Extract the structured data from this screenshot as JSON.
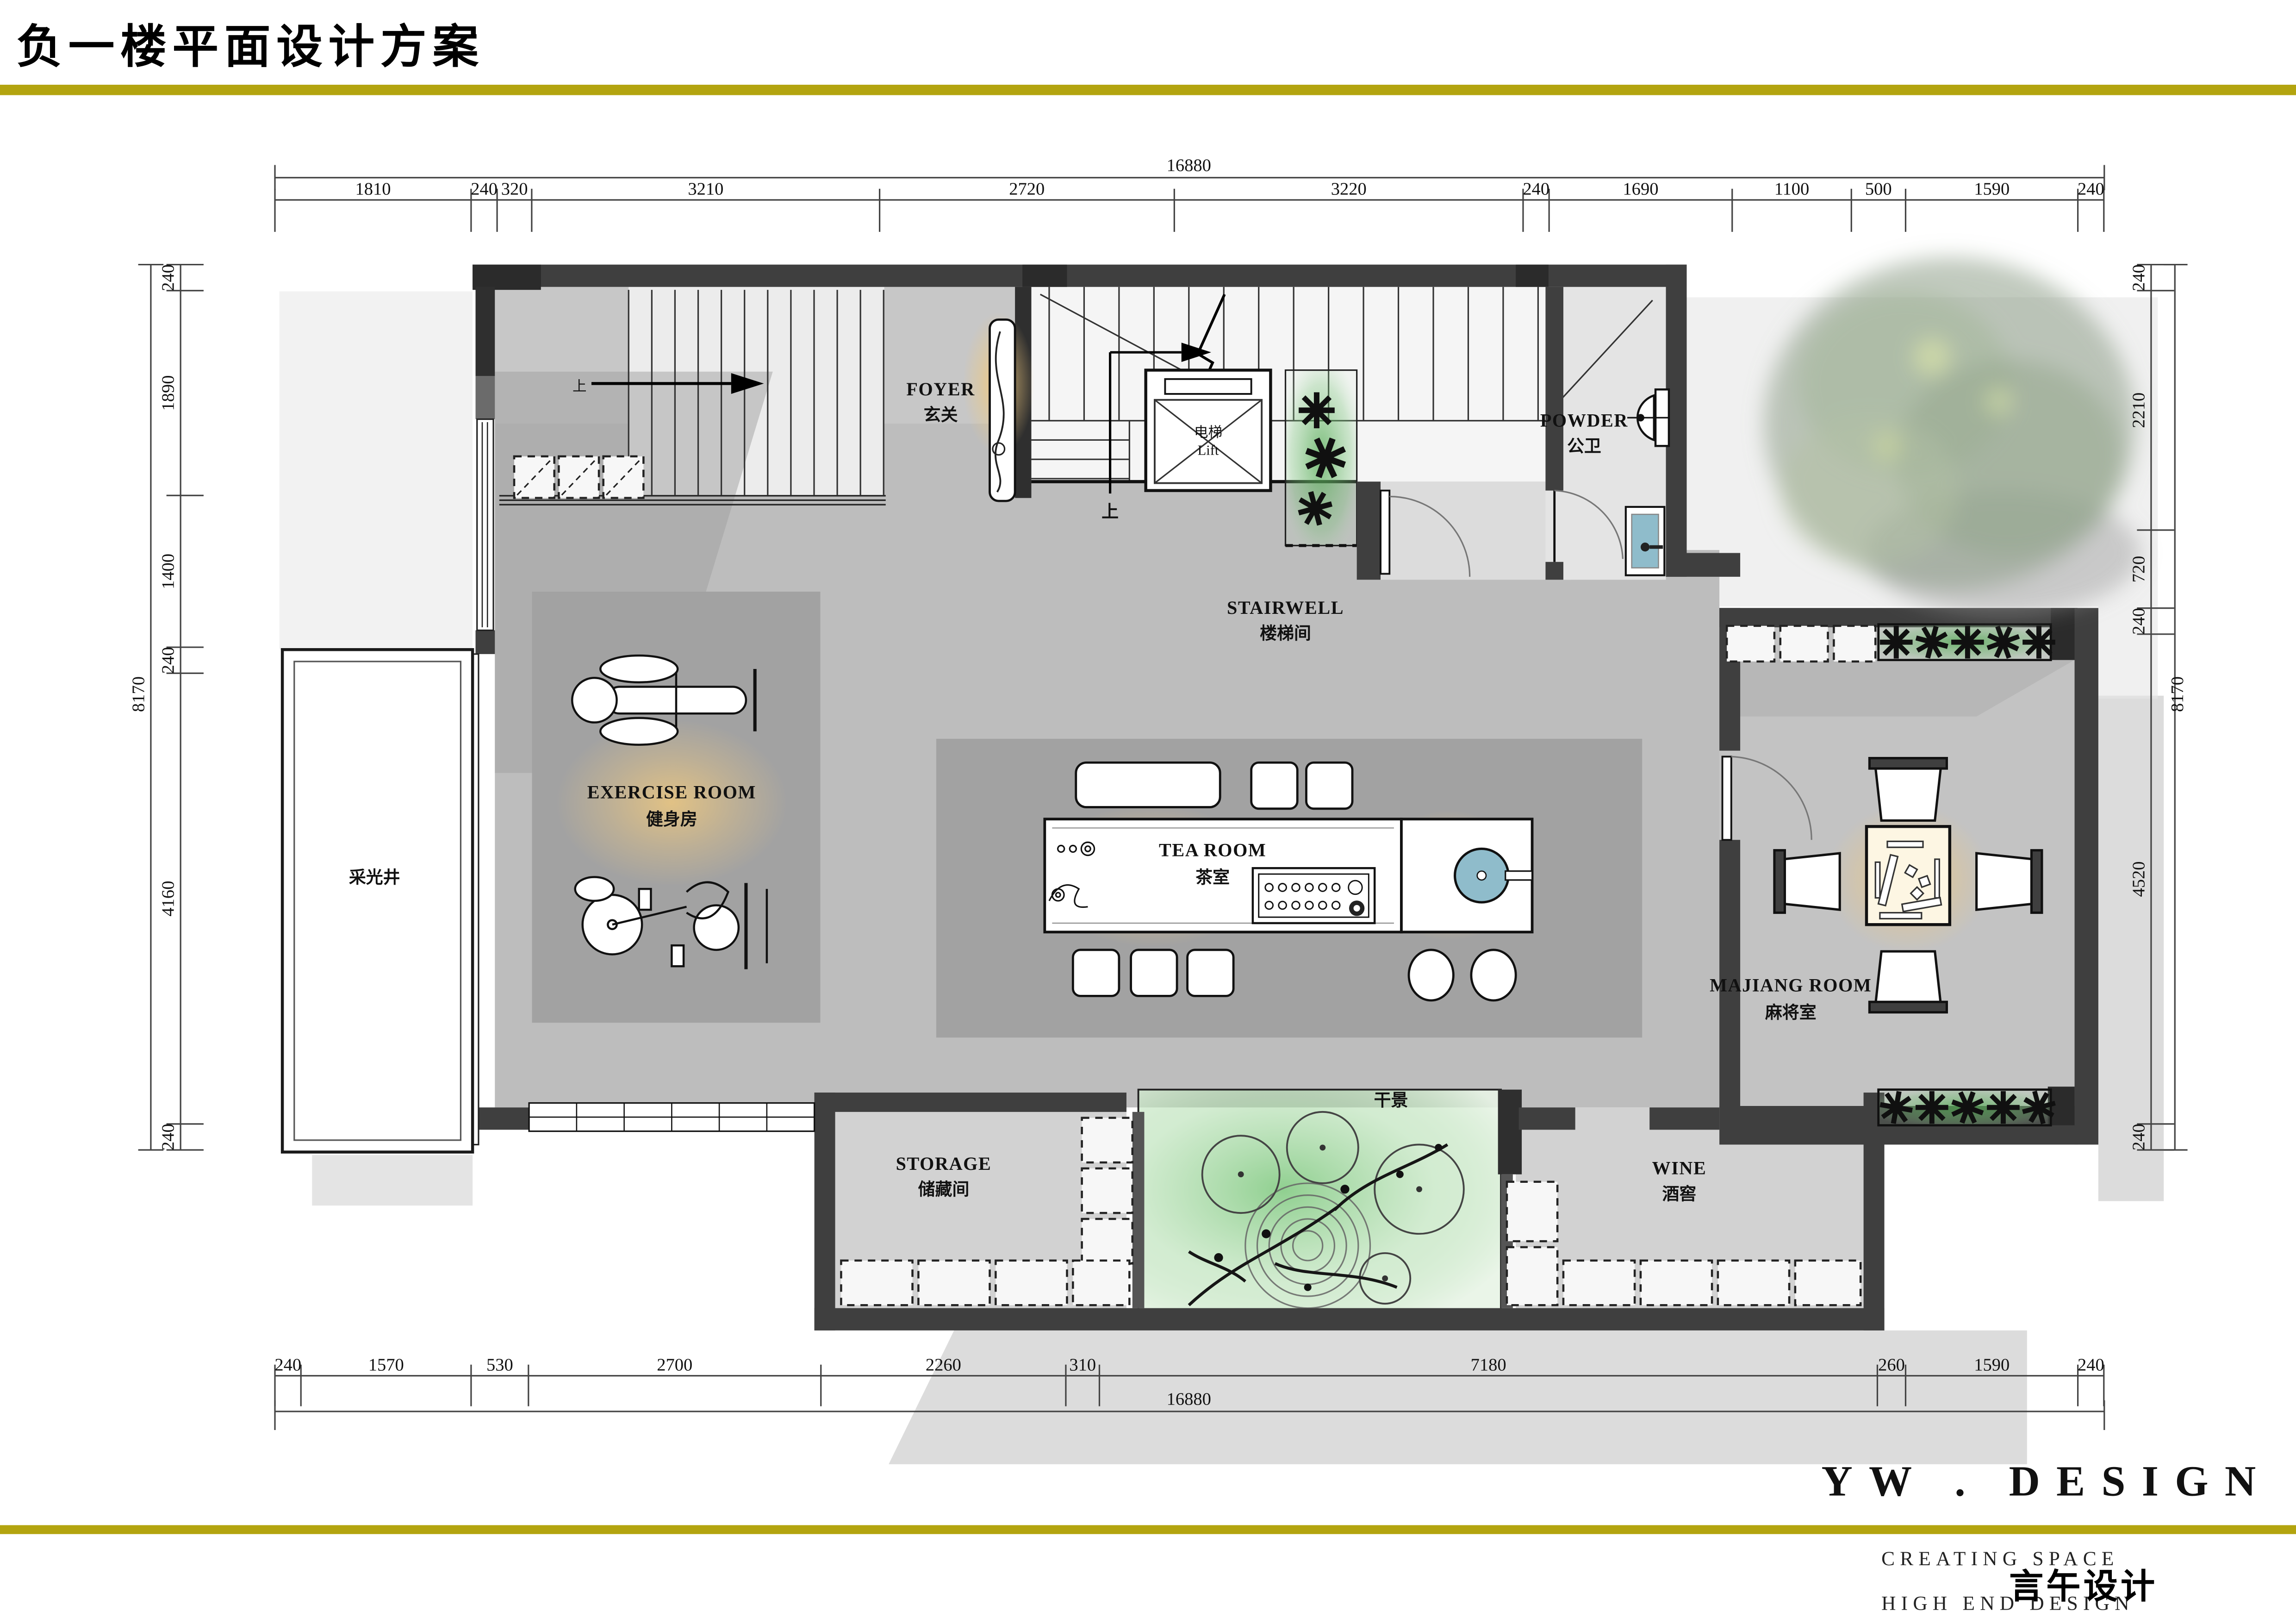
{
  "page": {
    "title": "负一楼平面设计方案"
  },
  "brand": {
    "logo": "YW . DESIGN",
    "slogan1": "CREATING SPACE",
    "slogan2": "HIGH END DESIGN",
    "cn_name": "言午设计"
  },
  "colors": {
    "accent_olive": "#b3a40f",
    "wall_dark": "#3f3f3f",
    "floor_gray": "#bdbdbd",
    "plant_green": "#4ea84e",
    "glow_warm": "#f0c97e",
    "water_blue": "#8fbccb"
  },
  "rooms": {
    "foyer": {
      "en": "FOYER",
      "zh": "玄关"
    },
    "stairwell": {
      "en": "STAIRWELL",
      "zh": "楼梯间"
    },
    "lift": {
      "zh": "电梯",
      "en": "Lift"
    },
    "powder": {
      "en": "POWDER",
      "zh": "公卫"
    },
    "exercise": {
      "en": "EXERCISE  ROOM",
      "zh": "健身房"
    },
    "tea": {
      "en": "TEA  ROOM",
      "zh": "茶室"
    },
    "majiang": {
      "en": "MAJIANG  ROOM",
      "zh": "麻将室"
    },
    "storage": {
      "en": "STORAGE",
      "zh": "储藏间"
    },
    "wine": {
      "en": "WINE",
      "zh": "酒窖"
    },
    "dry_landscape": {
      "zh": "干景"
    },
    "light_well": {
      "zh": "采光井"
    },
    "stair_up": {
      "zh": "上"
    }
  },
  "dimensions": {
    "top": {
      "overall": "16880",
      "segments": [
        "1810",
        "240",
        "320",
        "3210",
        "2720",
        "3220",
        "240",
        "1690",
        "1100",
        "500",
        "1590",
        "240"
      ]
    },
    "bottom": {
      "overall": "16880",
      "segments": [
        "240",
        "1570",
        "530",
        "2700",
        "2260",
        "310",
        "7180",
        "260",
        "1590",
        "240"
      ]
    },
    "left": {
      "overall": "8170",
      "segments": [
        "240",
        "1890",
        "1400",
        "240",
        "4160",
        "240"
      ]
    },
    "right": {
      "overall": "8170",
      "segments": [
        "240",
        "2210",
        "720",
        "240",
        "4520",
        "240"
      ]
    }
  }
}
